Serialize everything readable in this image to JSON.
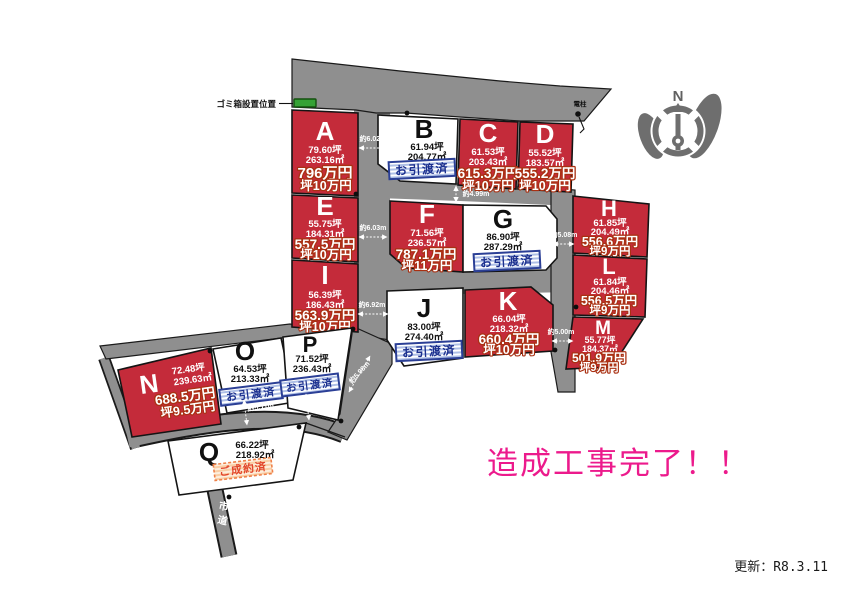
{
  "banner": "造成工事完了！！",
  "update_note": "更新：R8.3.11",
  "map": {
    "trash_label": "ゴミ箱設置位置",
    "pole_label": "電柱",
    "road_label": "市道",
    "compass_north": "N"
  },
  "status_labels": {
    "delivered": "お引渡済",
    "contracted": "ご成約済"
  },
  "colors": {
    "available_plot_red": "#c42b3a",
    "sold_plot_white": "#ffffff",
    "road_gray": "#8f8f8f",
    "banner_pink": "#ec1a8c",
    "delivered_blue": "#1b2f8e",
    "contracted_orange": "#e2452a",
    "trash_box_green": "#35a235",
    "price_outline": "#a93012"
  },
  "plots": [
    {
      "id": "A",
      "tsubo": "79.60坪",
      "sqm": "263.16㎡",
      "price": "796万円",
      "unit_price": "坪10万円",
      "status": "available"
    },
    {
      "id": "B",
      "tsubo": "61.94坪",
      "sqm": "204.77㎡",
      "price": "",
      "unit_price": "",
      "status": "delivered"
    },
    {
      "id": "C",
      "tsubo": "61.53坪",
      "sqm": "203.43㎡",
      "price": "615.3万円",
      "unit_price": "坪10万円",
      "status": "available"
    },
    {
      "id": "D",
      "tsubo": "55.52坪",
      "sqm": "183.57㎡",
      "price": "555.2万円",
      "unit_price": "坪10万円",
      "status": "available"
    },
    {
      "id": "E",
      "tsubo": "55.75坪",
      "sqm": "184.31㎡",
      "price": "557.5万円",
      "unit_price": "坪10万円",
      "status": "available"
    },
    {
      "id": "F",
      "tsubo": "71.56坪",
      "sqm": "236.57㎡",
      "price": "787.1万円",
      "unit_price": "坪11万円",
      "status": "available"
    },
    {
      "id": "G",
      "tsubo": "86.90坪",
      "sqm": "287.29㎡",
      "price": "",
      "unit_price": "",
      "status": "delivered"
    },
    {
      "id": "H",
      "tsubo": "61.85坪",
      "sqm": "204.49㎡",
      "price": "556.6万円",
      "unit_price": "坪9万円",
      "status": "available"
    },
    {
      "id": "I",
      "tsubo": "56.39坪",
      "sqm": "186.43㎡",
      "price": "563.9万円",
      "unit_price": "坪10万円",
      "status": "available"
    },
    {
      "id": "J",
      "tsubo": "83.00坪",
      "sqm": "274.40㎡",
      "price": "",
      "unit_price": "",
      "status": "delivered"
    },
    {
      "id": "K",
      "tsubo": "66.04坪",
      "sqm": "218.32㎡",
      "price": "660.4万円",
      "unit_price": "坪10万円",
      "status": "available"
    },
    {
      "id": "L",
      "tsubo": "61.84坪",
      "sqm": "204.46㎡",
      "price": "556.5万円",
      "unit_price": "坪9万円",
      "status": "available"
    },
    {
      "id": "M",
      "tsubo": "55.77坪",
      "sqm": "184.37㎡",
      "price": "501.9万円",
      "unit_price": "坪9万円",
      "status": "available"
    },
    {
      "id": "N",
      "tsubo": "72.48坪",
      "sqm": "239.63㎡",
      "price": "688.5万円",
      "unit_price": "坪9.5万円",
      "status": "available"
    },
    {
      "id": "O",
      "tsubo": "64.53坪",
      "sqm": "213.33㎡",
      "price": "",
      "unit_price": "",
      "status": "delivered"
    },
    {
      "id": "P",
      "tsubo": "71.52坪",
      "sqm": "236.43㎡",
      "price": "",
      "unit_price": "",
      "status": "delivered"
    },
    {
      "id": "Q",
      "tsubo": "66.22坪",
      "sqm": "218.92㎡",
      "price": "",
      "unit_price": "",
      "status": "contracted"
    }
  ],
  "dimensions": {
    "d1": "約6.02m",
    "d2": "約6.03m",
    "d3": "約4.99m",
    "d4": "約5.08m",
    "d5": "約6.92m",
    "d6": "約5.00m",
    "d7": "約5.11m",
    "d8": "約5.30m",
    "d9": "約5.98m"
  }
}
